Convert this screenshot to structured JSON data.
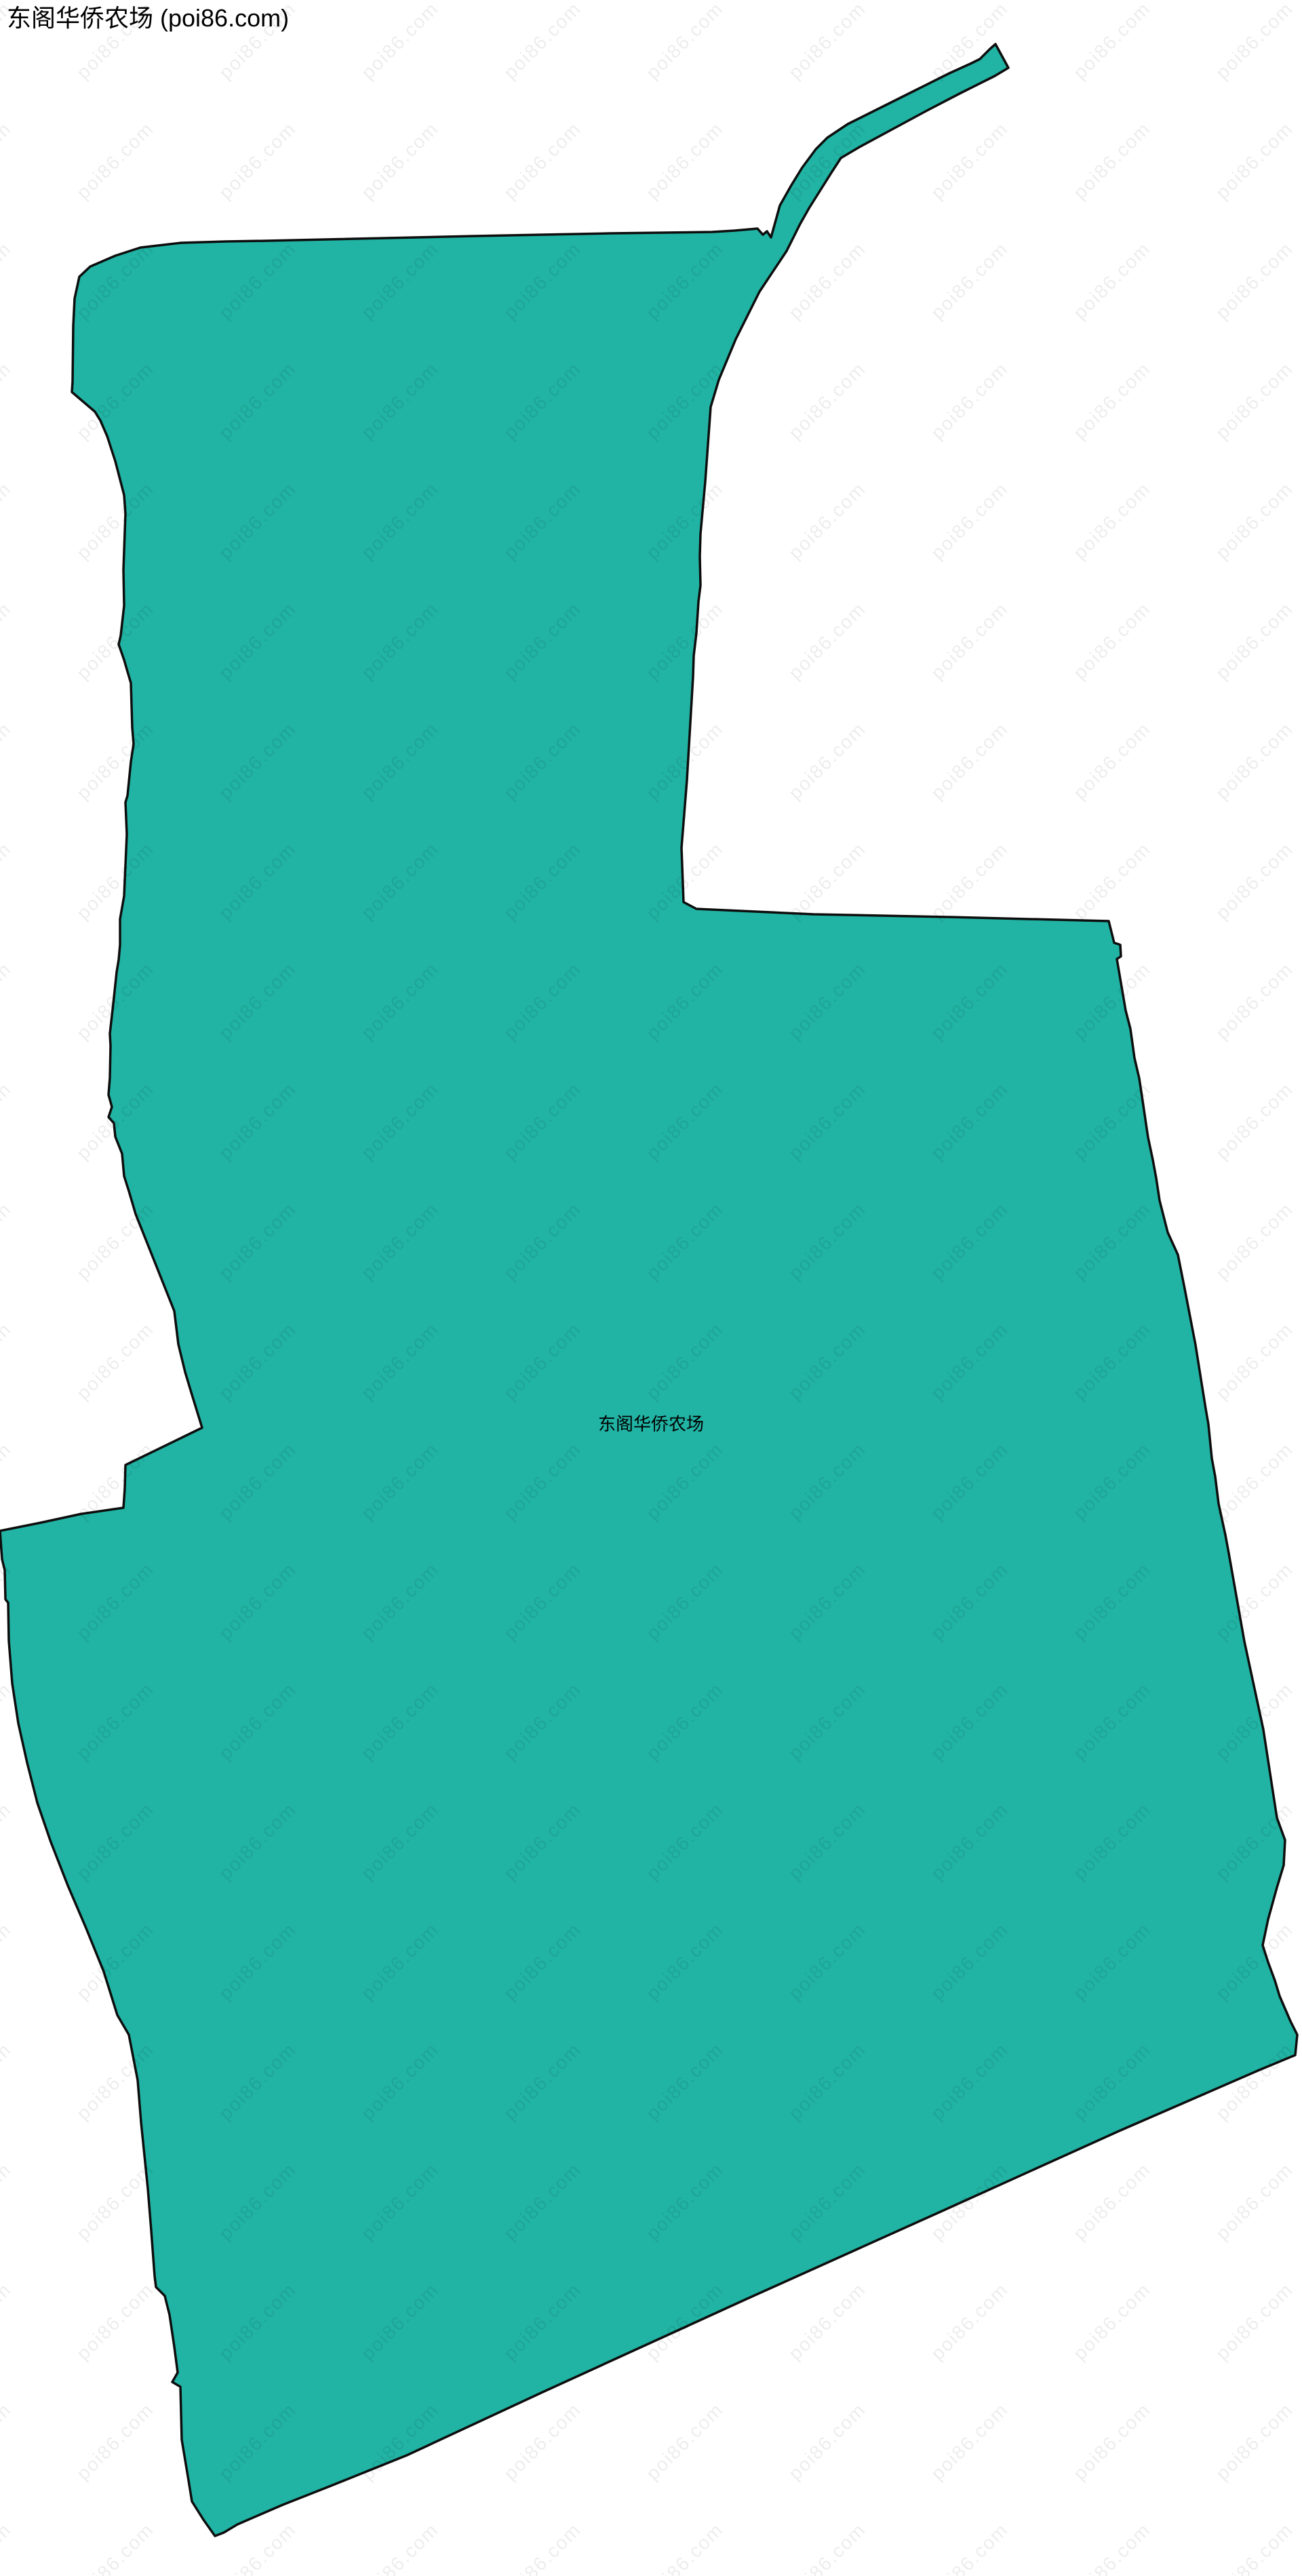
{
  "header": {
    "title": "东阁华侨农场 (poi86.com)"
  },
  "map": {
    "label": "东阁华侨农场",
    "watermark_text": "poi86.com",
    "colors": {
      "background": "#ffffff",
      "region_fill": "#21B3A3",
      "region_stroke": "#0d0d0d",
      "watermark": "rgba(0,0,0,0.07)",
      "title_color": "#000000",
      "label_color": "#000000"
    },
    "region_outline": [
      [
        117,
        408
      ],
      [
        133,
        393
      ],
      [
        170,
        377
      ],
      [
        207,
        365
      ],
      [
        267,
        358
      ],
      [
        333,
        356
      ],
      [
        393,
        355
      ],
      [
        700,
        348
      ],
      [
        900,
        344
      ],
      [
        1050,
        342
      ],
      [
        1083,
        340
      ],
      [
        1117,
        337
      ],
      [
        1125,
        346
      ],
      [
        1131,
        341
      ],
      [
        1137,
        350
      ],
      [
        1150,
        303
      ],
      [
        1167,
        273
      ],
      [
        1183,
        247
      ],
      [
        1203,
        220
      ],
      [
        1220,
        203
      ],
      [
        1250,
        183
      ],
      [
        1300,
        158
      ],
      [
        1350,
        133
      ],
      [
        1400,
        108
      ],
      [
        1433,
        93
      ],
      [
        1445,
        87
      ],
      [
        1460,
        72
      ],
      [
        1468,
        65
      ],
      [
        1487,
        100
      ],
      [
        1467,
        112
      ],
      [
        1417,
        137
      ],
      [
        1367,
        163
      ],
      [
        1317,
        190
      ],
      [
        1267,
        217
      ],
      [
        1240,
        233
      ],
      [
        1227,
        253
      ],
      [
        1210,
        280
      ],
      [
        1193,
        307
      ],
      [
        1180,
        330
      ],
      [
        1170,
        350
      ],
      [
        1160,
        370
      ],
      [
        1120,
        430
      ],
      [
        1085,
        500
      ],
      [
        1060,
        560
      ],
      [
        1048,
        600
      ],
      [
        1040,
        710
      ],
      [
        1033,
        787
      ],
      [
        1032,
        820
      ],
      [
        1033,
        863
      ],
      [
        1030,
        887
      ],
      [
        1027,
        933
      ],
      [
        1023,
        967
      ],
      [
        1022,
        998
      ],
      [
        1013,
        1150
      ],
      [
        1005,
        1250
      ],
      [
        1008,
        1330
      ],
      [
        1027,
        1340
      ],
      [
        1200,
        1348
      ],
      [
        1400,
        1352
      ],
      [
        1635,
        1358
      ],
      [
        1643,
        1390
      ],
      [
        1652,
        1393
      ],
      [
        1653,
        1410
      ],
      [
        1647,
        1414
      ],
      [
        1660,
        1490
      ],
      [
        1667,
        1517
      ],
      [
        1673,
        1560
      ],
      [
        1680,
        1590
      ],
      [
        1685,
        1623
      ],
      [
        1690,
        1657
      ],
      [
        1693,
        1677
      ],
      [
        1700,
        1710
      ],
      [
        1705,
        1737
      ],
      [
        1710,
        1770
      ],
      [
        1722,
        1817
      ],
      [
        1737,
        1850
      ],
      [
        1747,
        1900
      ],
      [
        1758,
        1957
      ],
      [
        1763,
        1983
      ],
      [
        1770,
        2027
      ],
      [
        1778,
        2077
      ],
      [
        1782,
        2100
      ],
      [
        1787,
        2150
      ],
      [
        1792,
        2177
      ],
      [
        1797,
        2217
      ],
      [
        1807,
        2263
      ],
      [
        1812,
        2290
      ],
      [
        1835,
        2420
      ],
      [
        1863,
        2550
      ],
      [
        1883,
        2680
      ],
      [
        1895,
        2713
      ],
      [
        1893,
        2750
      ],
      [
        1883,
        2783
      ],
      [
        1870,
        2830
      ],
      [
        1862,
        2868
      ],
      [
        1870,
        2893
      ],
      [
        1880,
        2920
      ],
      [
        1887,
        2943
      ],
      [
        1903,
        2980
      ],
      [
        1913,
        3000
      ],
      [
        1910,
        3030
      ],
      [
        1857,
        3052
      ],
      [
        1650,
        3142
      ],
      [
        1400,
        3255
      ],
      [
        1100,
        3390
      ],
      [
        800,
        3527
      ],
      [
        600,
        3620
      ],
      [
        483,
        3667
      ],
      [
        417,
        3693
      ],
      [
        350,
        3722
      ],
      [
        330,
        3734
      ],
      [
        317,
        3739
      ],
      [
        300,
        3715
      ],
      [
        283,
        3688
      ],
      [
        278,
        3657
      ],
      [
        273,
        3627
      ],
      [
        268,
        3597
      ],
      [
        266,
        3519
      ],
      [
        254,
        3512
      ],
      [
        262,
        3498
      ],
      [
        257,
        3460
      ],
      [
        250,
        3413
      ],
      [
        243,
        3385
      ],
      [
        230,
        3372
      ],
      [
        228,
        3356
      ],
      [
        223,
        3289
      ],
      [
        218,
        3227
      ],
      [
        208,
        3129
      ],
      [
        203,
        3067
      ],
      [
        190,
        3000
      ],
      [
        173,
        2971
      ],
      [
        153,
        2907
      ],
      [
        127,
        2843
      ],
      [
        100,
        2780
      ],
      [
        75,
        2716
      ],
      [
        55,
        2658
      ],
      [
        40,
        2599
      ],
      [
        27,
        2541
      ],
      [
        18,
        2482
      ],
      [
        13,
        2419
      ],
      [
        12,
        2363
      ],
      [
        8,
        2358
      ],
      [
        7,
        2315
      ],
      [
        3,
        2299
      ],
      [
        0,
        2257
      ],
      [
        60,
        2245
      ],
      [
        120,
        2232
      ],
      [
        182,
        2223
      ],
      [
        184,
        2195
      ],
      [
        185,
        2160
      ],
      [
        298,
        2105
      ],
      [
        282,
        2053
      ],
      [
        273,
        2023
      ],
      [
        263,
        1982
      ],
      [
        257,
        1933
      ],
      [
        200,
        1790
      ],
      [
        190,
        1756
      ],
      [
        183,
        1734
      ],
      [
        180,
        1701
      ],
      [
        170,
        1676
      ],
      [
        168,
        1656
      ],
      [
        160,
        1647
      ],
      [
        165,
        1632
      ],
      [
        160,
        1614
      ],
      [
        162,
        1589
      ],
      [
        163,
        1542
      ],
      [
        162,
        1524
      ],
      [
        167,
        1480
      ],
      [
        172,
        1433
      ],
      [
        175,
        1415
      ],
      [
        177,
        1393
      ],
      [
        177,
        1355
      ],
      [
        183,
        1321
      ],
      [
        187,
        1230
      ],
      [
        185,
        1183
      ],
      [
        188,
        1173
      ],
      [
        193,
        1123
      ],
      [
        197,
        1097
      ],
      [
        195,
        1073
      ],
      [
        193,
        1007
      ],
      [
        190,
        997
      ],
      [
        183,
        973
      ],
      [
        175,
        950
      ],
      [
        178,
        937
      ],
      [
        183,
        893
      ],
      [
        182,
        840
      ],
      [
        185,
        757
      ],
      [
        183,
        730
      ],
      [
        170,
        680
      ],
      [
        158,
        643
      ],
      [
        148,
        620
      ],
      [
        140,
        607
      ],
      [
        106,
        578
      ],
      [
        107,
        563
      ],
      [
        108,
        480
      ],
      [
        110,
        440
      ]
    ]
  }
}
